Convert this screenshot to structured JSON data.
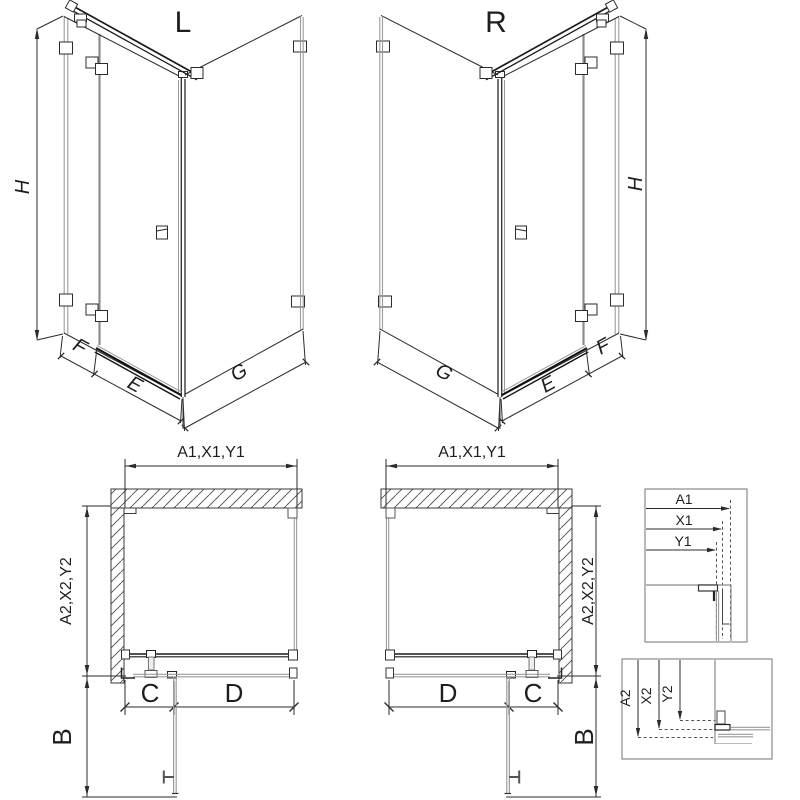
{
  "iso_views": {
    "left": {
      "variant_label": "L",
      "height": "H",
      "fixed_panel": "F",
      "door": "E",
      "side_panel": "G"
    },
    "right": {
      "variant_label": "R",
      "height": "H",
      "fixed_panel": "F",
      "door": "E",
      "side_panel": "G"
    }
  },
  "plan_views": {
    "left": {
      "width_dim": "A1,X1,Y1",
      "depth_dim": "A2,X2,Y2",
      "door_swing": "B",
      "fixed_segment": "C",
      "door_segment": "D"
    },
    "right": {
      "width_dim": "A1,X1,Y1",
      "depth_dim": "A2,X2,Y2",
      "door_swing": "B",
      "fixed_segment": "C",
      "door_segment": "D"
    }
  },
  "detail_boxes": {
    "width_reference": {
      "labels": [
        "A1",
        "X1",
        "Y1"
      ]
    },
    "depth_reference": {
      "labels": [
        "A2",
        "X2",
        "Y2"
      ]
    }
  },
  "colors": {
    "background": "#ffffff",
    "line": "#2b2b2b",
    "profile_grey": "#9b9b9b",
    "bar_dark": "#1a1a1a",
    "frame_grey": "#8a8a8a"
  }
}
